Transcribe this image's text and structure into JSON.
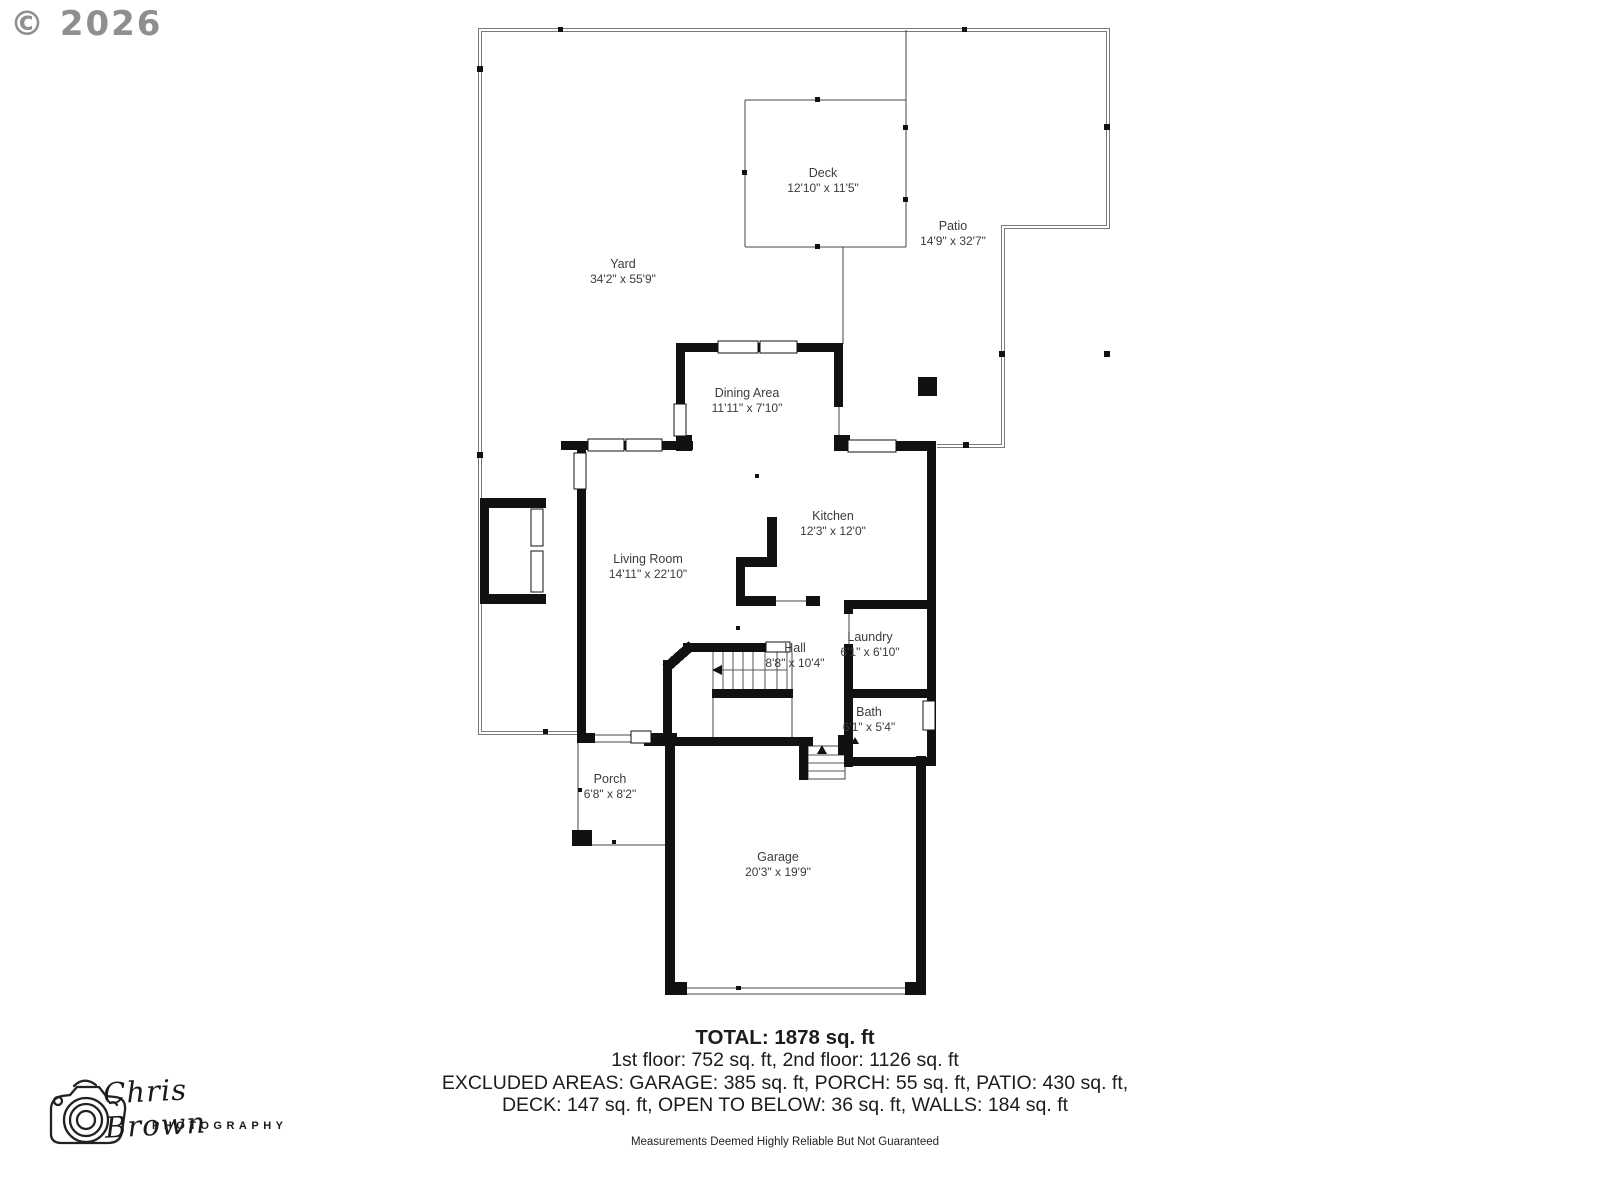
{
  "copyright": "© 2026",
  "rooms": {
    "yard": {
      "name": "Yard",
      "dims": "34'2\" x 55'9\""
    },
    "deck": {
      "name": "Deck",
      "dims": "12'10\" x 11'5\""
    },
    "patio": {
      "name": "Patio",
      "dims": "14'9\" x 32'7\""
    },
    "dining": {
      "name": "Dining Area",
      "dims": "11'11\" x 7'10\""
    },
    "kitchen": {
      "name": "Kitchen",
      "dims": "12'3\" x 12'0\""
    },
    "living": {
      "name": "Living Room",
      "dims": "14'11\" x 22'10\""
    },
    "hall": {
      "name": "Hall",
      "dims": "8'8\" x 10'4\""
    },
    "laundry": {
      "name": "Laundry",
      "dims": "6'1\" x 6'10\""
    },
    "bath": {
      "name": "Bath",
      "dims": "6'1\" x 5'4\""
    },
    "porch": {
      "name": "Porch",
      "dims": "6'8\" x 8'2\""
    },
    "garage": {
      "name": "Garage",
      "dims": "20'3\" x 19'9\""
    }
  },
  "summary": {
    "total": "TOTAL: 1878 sq. ft",
    "floors": "1st floor: 752 sq. ft, 2nd floor: 1126 sq. ft",
    "excluded_line1": "EXCLUDED AREAS: GARAGE: 385 sq. ft, PORCH: 55 sq. ft, PATIO: 430 sq. ft,",
    "excluded_line2": "DECK: 147 sq. ft, OPEN TO BELOW: 36 sq. ft, WALLS: 184 sq. ft",
    "disclaimer": "Measurements Deemed Highly Reliable But Not Guaranteed"
  },
  "brand": {
    "name": "Chris Brown",
    "subtitle": "PHOTOGRAPHY"
  },
  "colors": {
    "wall": "#111111",
    "boundary": "#7a7a7a",
    "thin_line": "#444444",
    "label": "#3b3b3b"
  }
}
